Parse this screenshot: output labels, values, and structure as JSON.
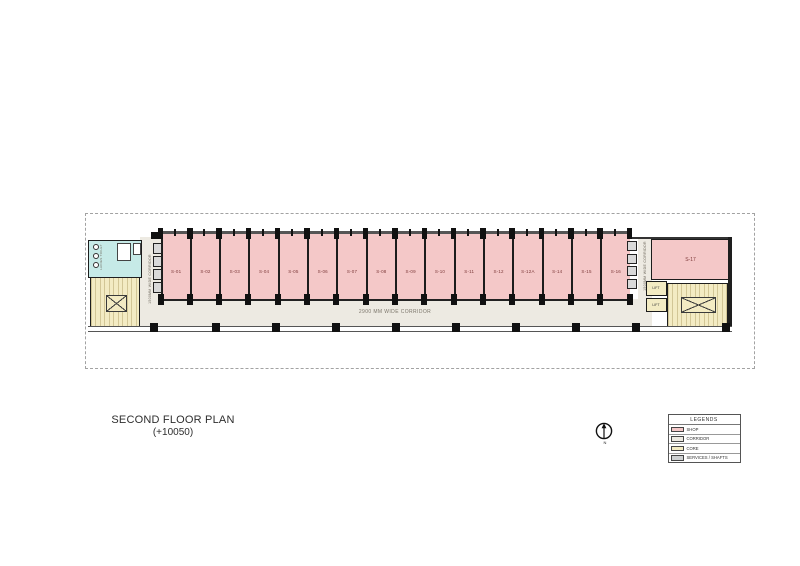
{
  "title_block": {
    "title": "SECOND FLOOR PLAN",
    "level": "(+10050)"
  },
  "corridors": {
    "main": "2900 MM WIDE CORRIDOR",
    "left": "1500MM WIDE CORRIDOR",
    "right": "1500MM WIDE CORRIDOR"
  },
  "shops": {
    "units": [
      "S-01",
      "S-02",
      "S-03",
      "S-04",
      "S-05",
      "S-06",
      "S-07",
      "S-08",
      "S-09",
      "S-10",
      "S-11",
      "S-12",
      "S-12A",
      "S-14",
      "S-15",
      "S-16"
    ],
    "end_unit": "S-17"
  },
  "core": {
    "lift_upper": "LIFT",
    "lift_lower": "LIFT",
    "toilet_label": "LADIES TOILET"
  },
  "north": {
    "label": "N"
  },
  "legend": {
    "header": "LEGENDS",
    "items": [
      {
        "label": "SHOP",
        "color": "#f4c8c8"
      },
      {
        "label": "CORRIDOR",
        "color": "#edeae2"
      },
      {
        "label": "CORE",
        "color": "#f3ebc3"
      },
      {
        "label": "SERVICES / SHAFTS",
        "color": "#ced1d2"
      }
    ]
  },
  "colors": {
    "shop": "#f4c8c8",
    "corridor": "#edeae2",
    "core": "#f3ebc3",
    "services": "#c6eae7",
    "wall": "#1e1e1e"
  }
}
